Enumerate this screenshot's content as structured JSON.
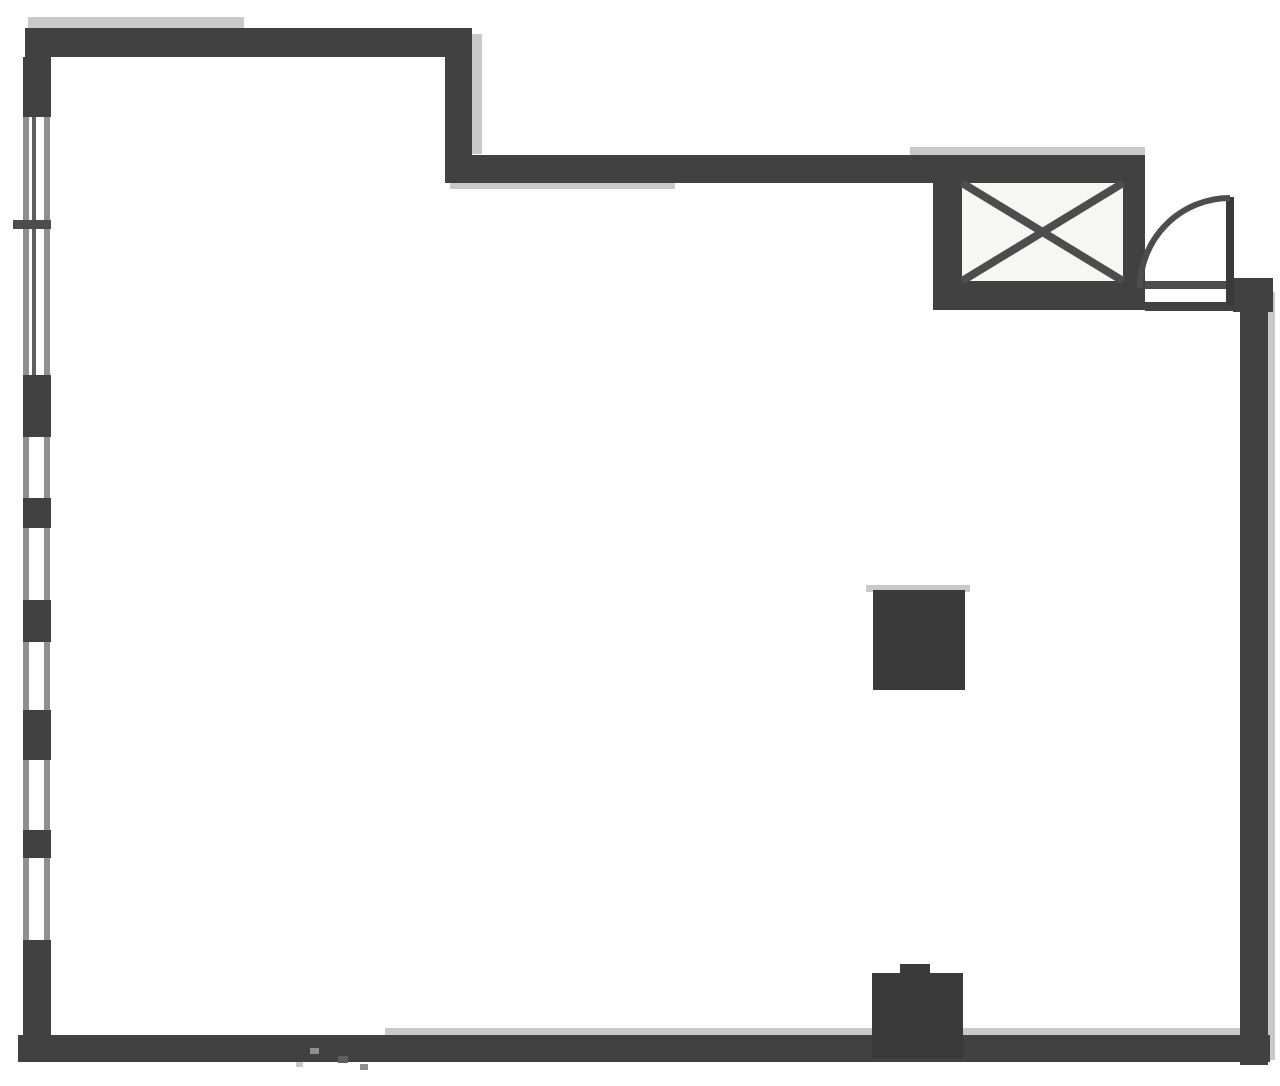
{
  "meta": {
    "description": "Scanned black-and-white architectural floor plan of a single open room with elevator shaft, entry door, window wall and two structural columns",
    "canvas": {
      "width": 1280,
      "height": 1086
    }
  },
  "colors": {
    "background": "#ffffff",
    "wall": "#414141",
    "wall_dark": "#3a3a3a",
    "interior": "#f6f6f5",
    "shadow": "#c9c9c9",
    "rail": "#8f8f8f",
    "rail_dark": "#5f5f5f",
    "line": "#4d4d4d"
  },
  "floor_plan": {
    "rects": [
      {
        "name": "top-wall-edge-shadow",
        "x": 28,
        "y": 17,
        "w": 216,
        "h": 12,
        "color": "shadow"
      },
      {
        "name": "setback-wall-side-shadow",
        "x": 472,
        "y": 34,
        "w": 10,
        "h": 120,
        "color": "shadow"
      },
      {
        "name": "upper-wall-underside-shadow",
        "x": 450,
        "y": 183,
        "w": 225,
        "h": 6,
        "color": "shadow"
      },
      {
        "name": "elevator-top-shadow",
        "x": 910,
        "y": 147,
        "w": 235,
        "h": 8,
        "color": "shadow"
      },
      {
        "name": "right-wall-outer-shadow",
        "x": 1268,
        "y": 292,
        "w": 7,
        "h": 768,
        "color": "shadow"
      },
      {
        "name": "bottom-wall-top-shadow",
        "x": 385,
        "y": 1028,
        "w": 858,
        "h": 7,
        "color": "shadow"
      },
      {
        "name": "top-wall-upper",
        "x": 25,
        "y": 28,
        "w": 447,
        "h": 29,
        "color": "wall"
      },
      {
        "name": "setback-wall",
        "x": 445,
        "y": 30,
        "w": 27,
        "h": 153,
        "color": "wall"
      },
      {
        "name": "top-wall-lower",
        "x": 448,
        "y": 155,
        "w": 697,
        "h": 28,
        "color": "wall"
      },
      {
        "name": "elevator-shaft-walls",
        "x": 933,
        "y": 155,
        "w": 212,
        "h": 155,
        "color": "wall"
      },
      {
        "name": "elevator-shaft-interior",
        "x": 962,
        "y": 183,
        "w": 161,
        "h": 98,
        "color": "interior"
      },
      {
        "name": "door-threshold-top-line",
        "x": 1145,
        "y": 281,
        "w": 90,
        "h": 8,
        "color": "line"
      },
      {
        "name": "door-threshold-bottom-line",
        "x": 1145,
        "y": 302,
        "w": 90,
        "h": 9,
        "color": "wall"
      },
      {
        "name": "entry-stub-wall",
        "x": 1233,
        "y": 278,
        "w": 40,
        "h": 34,
        "color": "wall"
      },
      {
        "name": "right-wall",
        "x": 1240,
        "y": 280,
        "w": 28,
        "h": 785,
        "color": "wall"
      },
      {
        "name": "bottom-wall",
        "x": 18,
        "y": 1035,
        "w": 1252,
        "h": 27,
        "color": "wall"
      },
      {
        "name": "bottom-column-notch",
        "x": 900,
        "y": 964,
        "w": 30,
        "h": 12,
        "color": "wall_dark"
      },
      {
        "name": "bottom-column",
        "x": 872,
        "y": 973,
        "w": 91,
        "h": 85,
        "color": "wall_dark"
      },
      {
        "name": "center-column-highlight",
        "x": 866,
        "y": 585,
        "w": 104,
        "h": 7,
        "color": "shadow"
      },
      {
        "name": "center-column",
        "x": 873,
        "y": 590,
        "w": 92,
        "h": 100,
        "color": "wall_dark"
      },
      {
        "name": "left-wall-outer-rail",
        "x": 23,
        "y": 57,
        "w": 6,
        "h": 978,
        "color": "rail"
      },
      {
        "name": "left-wall-inner-rail",
        "x": 44,
        "y": 57,
        "w": 6,
        "h": 978,
        "color": "rail"
      },
      {
        "name": "left-wall-glazing-line",
        "x": 32,
        "y": 117,
        "w": 4,
        "h": 258,
        "color": "rail_dark"
      },
      {
        "name": "left-wall-pier-1",
        "x": 23,
        "y": 57,
        "w": 28,
        "h": 60,
        "color": "wall"
      },
      {
        "name": "left-wall-pier-2",
        "x": 23,
        "y": 375,
        "w": 28,
        "h": 62,
        "color": "wall"
      },
      {
        "name": "left-wall-pier-3",
        "x": 23,
        "y": 498,
        "w": 28,
        "h": 30,
        "color": "wall"
      },
      {
        "name": "left-wall-pier-4",
        "x": 23,
        "y": 600,
        "w": 28,
        "h": 42,
        "color": "wall"
      },
      {
        "name": "left-wall-pier-5",
        "x": 23,
        "y": 710,
        "w": 28,
        "h": 50,
        "color": "wall"
      },
      {
        "name": "left-wall-pier-6",
        "x": 23,
        "y": 830,
        "w": 28,
        "h": 28,
        "color": "wall"
      },
      {
        "name": "left-wall-pier-7",
        "x": 23,
        "y": 940,
        "w": 28,
        "h": 95,
        "color": "wall"
      },
      {
        "name": "window-mullion-tick",
        "x": 13,
        "y": 220,
        "w": 38,
        "h": 9,
        "color": "line"
      },
      {
        "name": "entry-door-leaf",
        "x": 1226,
        "y": 197,
        "w": 8,
        "h": 108,
        "color": "wall_dark"
      },
      {
        "name": "scan-speckle-1",
        "x": 310,
        "y": 1048,
        "w": 9,
        "h": 6,
        "color": "rail"
      },
      {
        "name": "scan-speckle-2",
        "x": 338,
        "y": 1056,
        "w": 10,
        "h": 7,
        "color": "rail_dark"
      },
      {
        "name": "scan-speckle-3",
        "x": 360,
        "y": 1064,
        "w": 8,
        "h": 6,
        "color": "rail"
      },
      {
        "name": "scan-speckle-4",
        "x": 296,
        "y": 1062,
        "w": 7,
        "h": 5,
        "color": "shadow"
      }
    ],
    "svg_lines": [
      {
        "name": "elevator-x-line-1",
        "x1": 962,
        "y1": 183,
        "x2": 1123,
        "y2": 281,
        "stroke_width": 8
      },
      {
        "name": "elevator-x-line-2",
        "x1": 1123,
        "y1": 183,
        "x2": 962,
        "y2": 281,
        "stroke_width": 8
      }
    ],
    "svg_paths": [
      {
        "name": "door-swing-arc",
        "d": "M 1140 288 A 90 90 0 0 1 1230 198",
        "stroke_width": 6
      }
    ]
  }
}
